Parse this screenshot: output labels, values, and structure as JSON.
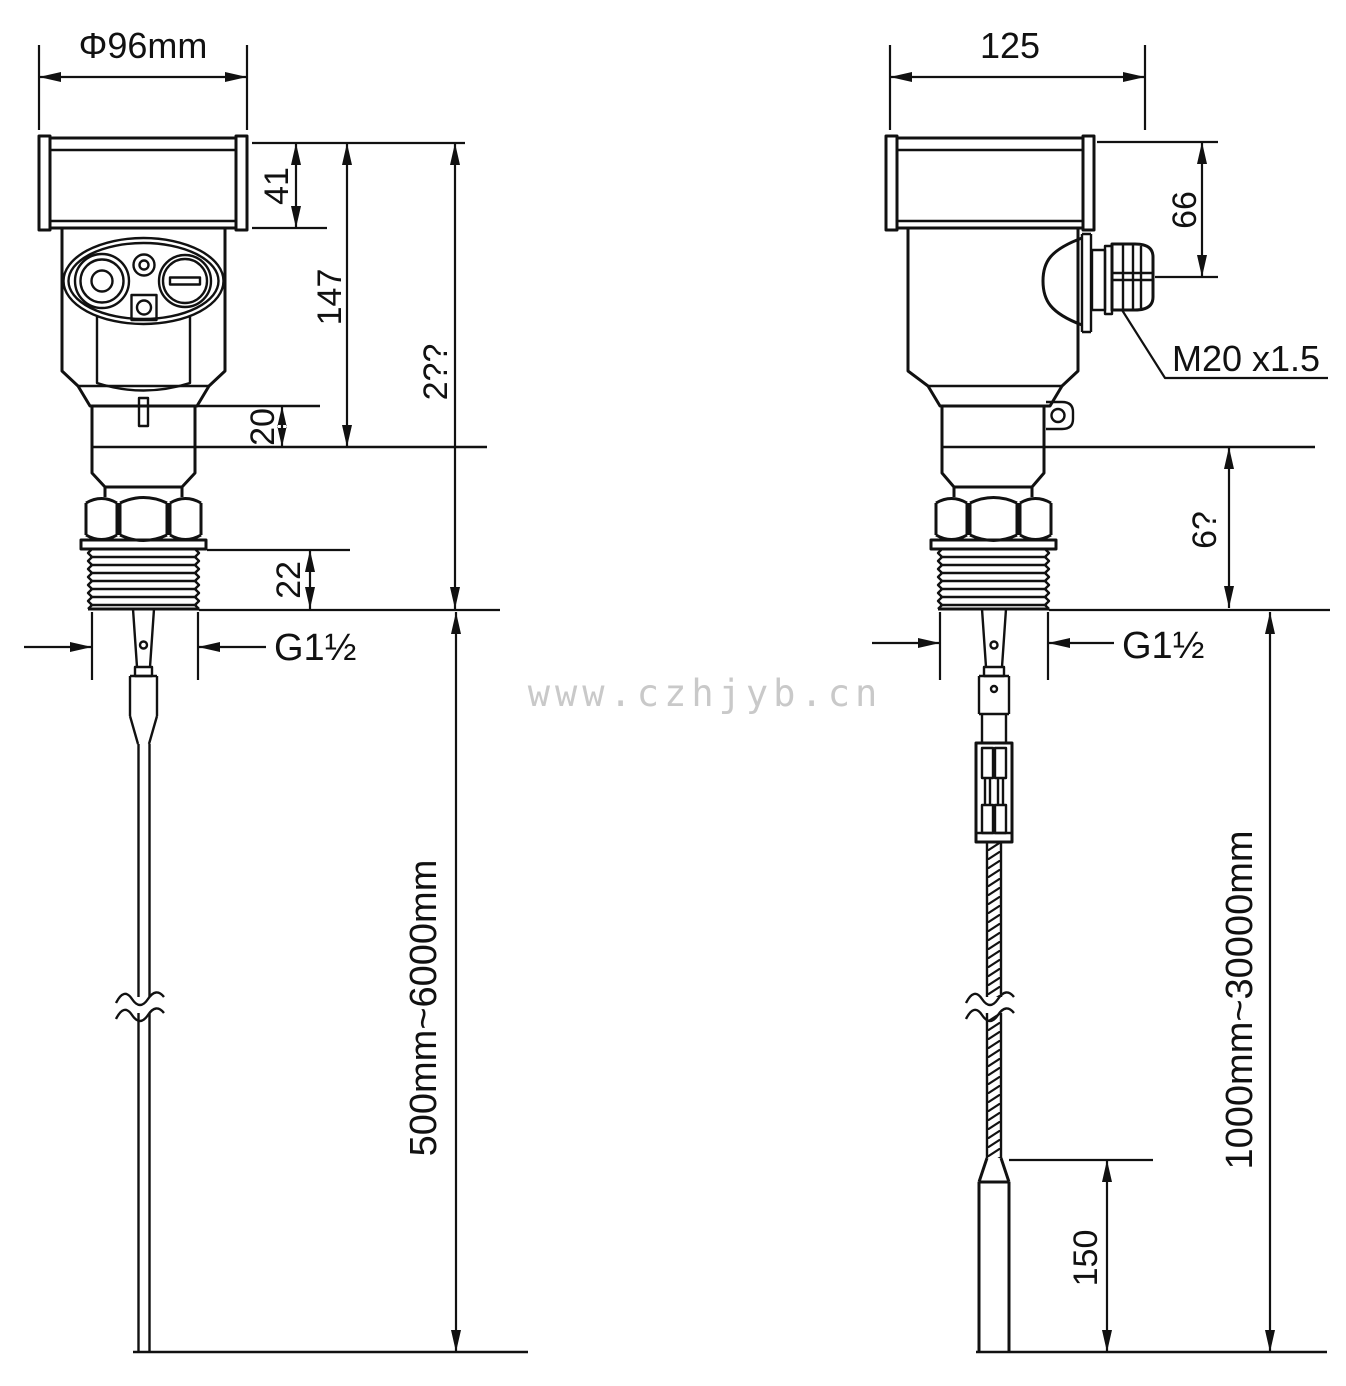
{
  "colors": {
    "ink": "#111111",
    "watermark_gray": "#c9c9c9"
  },
  "watermark": "www.czhjyb.cn",
  "left_view": {
    "description": "rod probe level transmitter front view",
    "labels": {
      "housing_diameter": "Φ96mm",
      "cap_height": "41",
      "head_height": "147",
      "overall_upper_height": "2??",
      "neck_height": "20",
      "thread_length": "22",
      "process_thread": "G1½",
      "probe_length_range": "500mm~6000mm"
    }
  },
  "right_view": {
    "description": "cable probe level transmitter side view",
    "labels": {
      "housing_width": "125",
      "gland_height": "66",
      "cable_gland_thread": "M20 x1.5",
      "lower_section_height": "6?",
      "process_thread": "G1½",
      "cable_length_range": "1000mm~30000mm",
      "counterweight_length": "150"
    }
  }
}
